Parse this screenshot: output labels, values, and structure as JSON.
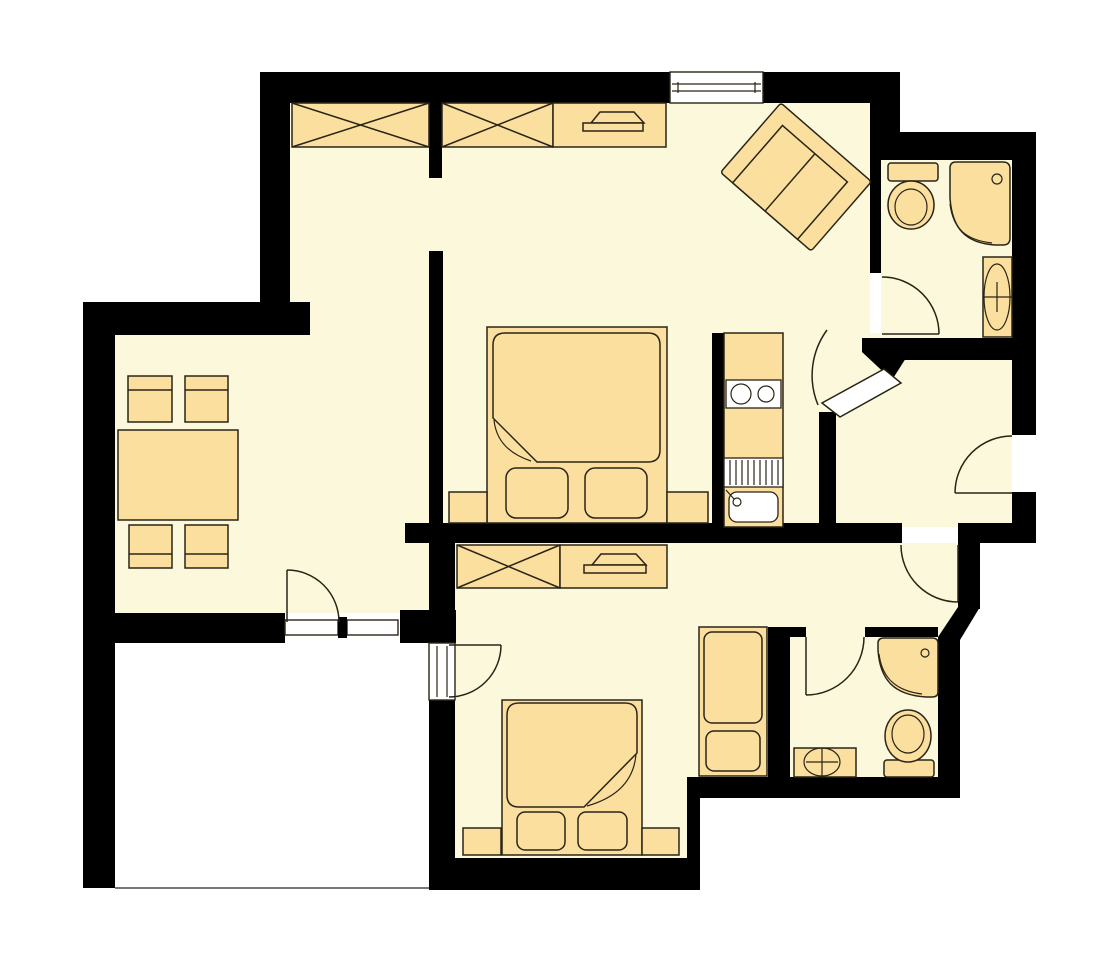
{
  "colors": {
    "background": "#ffffff",
    "floor": "#FBF8DC",
    "furniture": "#FBDF9E",
    "wall": "#000000",
    "outline": "#2A2416",
    "window": "#ffffff",
    "terrace_edge": "#4a4a4a"
  },
  "floor_plan": {
    "type": "apartment-floor-plan",
    "rooms": [
      {
        "name": "bedroom-1",
        "furniture": [
          "wardrobe-crossed",
          "wardrobe-crossed",
          "dresser-with-tv",
          "double-bed",
          "nightstand",
          "nightstand"
        ]
      },
      {
        "name": "living-room",
        "furniture": [
          "sofa-rotated"
        ]
      },
      {
        "name": "dining-area",
        "furniture": [
          "dining-table",
          "chair",
          "chair",
          "chair",
          "chair"
        ]
      },
      {
        "name": "kitchen-niche",
        "furniture": [
          "kitchen-unit",
          "cooktop-two-burners",
          "appliance",
          "kitchen-sink"
        ]
      },
      {
        "name": "bathroom-top",
        "fixtures": [
          "toilet",
          "shower",
          "washbasin"
        ]
      },
      {
        "name": "hall",
        "fixtures": []
      },
      {
        "name": "bedroom-2",
        "furniture": [
          "wardrobe-crossed",
          "dresser-with-tv",
          "double-bed",
          "nightstand",
          "nightstand",
          "tall-cabinet"
        ]
      },
      {
        "name": "bathroom-bottom",
        "fixtures": [
          "shower",
          "toilet",
          "washbasin"
        ]
      },
      {
        "name": "terrace",
        "furniture": []
      }
    ],
    "openings": {
      "windows": [
        "top-wall-window",
        "dining-terrace-window",
        "bedroom-2-terrace-window"
      ],
      "doors": [
        "dining-terrace-door",
        "bedroom-2-terrace-door",
        "bathroom-top-door",
        "living-hall-door",
        "entrance-door",
        "hall-bedroom-2-door",
        "bathroom-bottom-door"
      ]
    }
  }
}
